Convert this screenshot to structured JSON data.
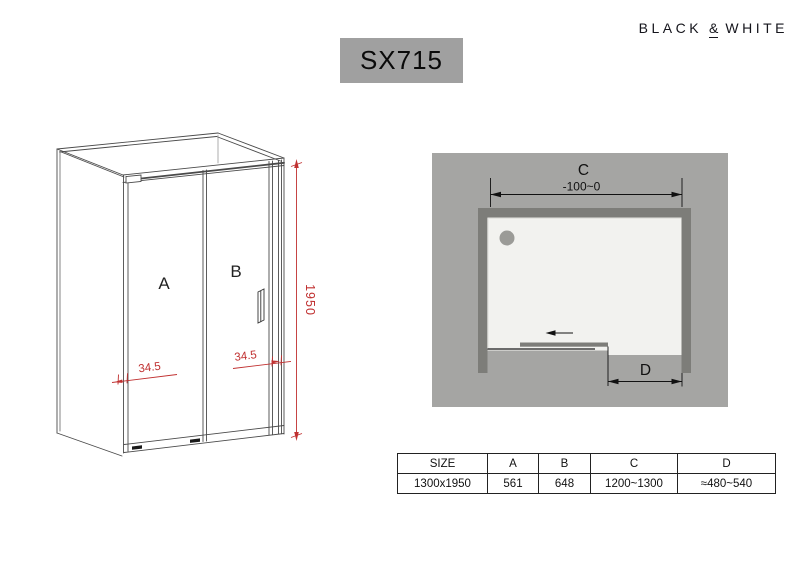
{
  "brand": {
    "name_left": "BLACK",
    "ampersand": "&",
    "name_right": "WHITE"
  },
  "header": {
    "model": "SX715"
  },
  "front_view": {
    "panel_a_label": "A",
    "panel_b_label": "B",
    "height_dim": "1950",
    "left_profile_dim": "34.5",
    "right_profile_dim": "34.5",
    "dim_color": "#c03030"
  },
  "top_view": {
    "width_dim_label": "C",
    "width_adjust_range": "-100~0",
    "opening_dim_label": "D",
    "colors": {
      "background": "#a5a5a3",
      "wall": "#7d7d79",
      "tray": "#f2f2ef",
      "drain": "#9b9b97"
    }
  },
  "spec_table": {
    "headers": [
      "SIZE",
      "A",
      "B",
      "C",
      "D"
    ],
    "row": [
      "1300x1950",
      "561",
      "648",
      "1200~1300",
      "≈480~540"
    ]
  }
}
